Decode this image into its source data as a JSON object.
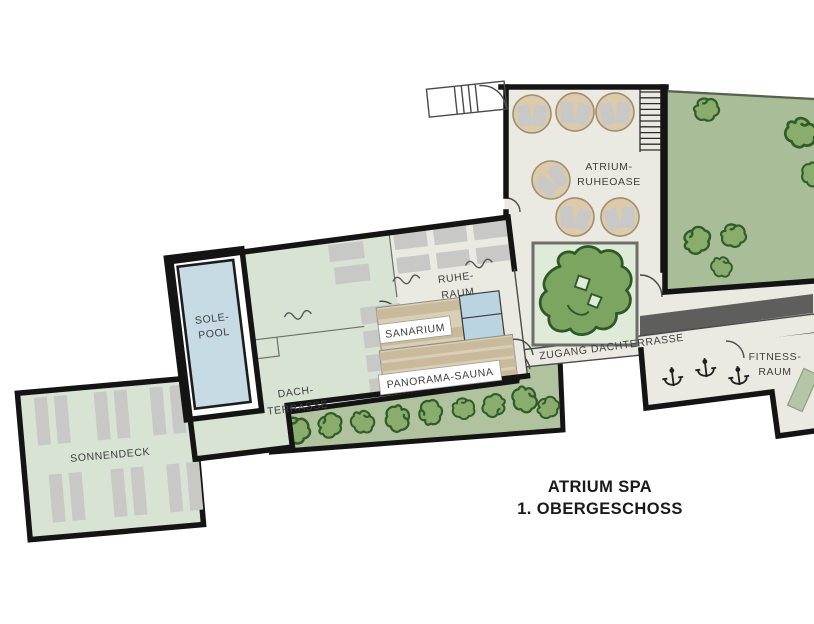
{
  "title": {
    "line1": "ATRIUM SPA",
    "line2": "1. OBERGESCHOSS"
  },
  "rooms": {
    "sole_pool": {
      "line1": "SOLE-",
      "line2": "POOL"
    },
    "dach_terrasse": {
      "line1": "DACH-",
      "line2": "TERRASSE"
    },
    "sonnendeck": {
      "label": "SONNENDECK"
    },
    "ruhe_raum": {
      "line1": "RUHE-",
      "line2": "RAUM"
    },
    "sanarium": {
      "label": "SANARIUM"
    },
    "panorama_sauna": {
      "label": "PANORAMA-SAUNA"
    },
    "atrium_ruheoase": {
      "line1": "ATRIUM-",
      "line2": "RUHEOASE"
    },
    "zugang_dachterrasse": {
      "label": "ZUGANG DACHTERRASSE"
    },
    "fitness_raum": {
      "line1": "FITNESS-",
      "line2": "RAUM"
    }
  },
  "colors": {
    "walls": "#141414",
    "room_offwhite": "#eaeae2",
    "terrace_green": "#d9e3d3",
    "pool_blue": "#c7dbe5",
    "tile_blue": "#bad4e2",
    "sauna_tan": "#d9cfb6",
    "sauna_bench": "#c9ba9c",
    "hedge_green": "#b1c29e",
    "bush_green": "#8aad6d",
    "bush_outline": "#2f5d28",
    "roof_green": "#a9bd98",
    "planter_green": "#e0ead9",
    "tree_green": "#7da562",
    "tree_outline": "#2c5926",
    "shadow_gray": "#5e5e5d",
    "lounger_gray": "#c8c8c6",
    "table_tan": "#dccaab",
    "mat_green": "#b5c6a8",
    "label_text": "#3d3d3d",
    "title_text": "#1a1a1a"
  }
}
